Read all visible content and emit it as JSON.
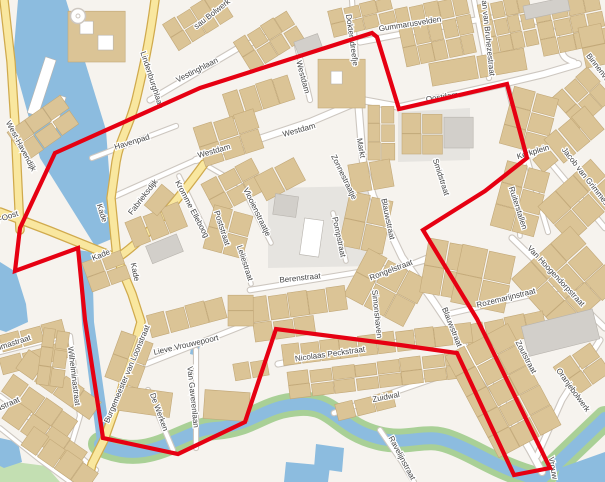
{
  "map": {
    "title": "Town centre map with red boundary overlay",
    "background": "#f6f3ee",
    "colors": {
      "water": "#8cbcdf",
      "green": "#a9d096",
      "green_light": "#c3dfb2",
      "road_fill": "#ffffff",
      "road_casing": "#cdc7c0",
      "yellow_fill": "#f9e79f",
      "yellow_casing": "#d0aa4d",
      "building_tan": "#dbc496",
      "building_tan_stroke": "#c2a878",
      "building_gray": "#d2cfca",
      "building_gray_stroke": "#b8b4ae",
      "building_white": "#ffffff",
      "plaza": "#e6e4e0",
      "label": "#454545",
      "boundary": "#e60012"
    },
    "boundary": {
      "name": "red-boundary-polygon",
      "width": 4.2,
      "points": "55,153 200,88 372,33 377,37 399,109 507,84 527,158 485,191 423,230 477,319 550,468 514,475 457,353 400,345 276,329 245,422 178,454 103,438 85,320 78,248 15,271 20,228"
    },
    "plazas": [
      "M268,188 L372,186 L372,266 L268,268 Z",
      "M398,112 L470,108 L470,160 L398,162 Z"
    ],
    "water_fills": [
      "M18,0 L66,0 L106,130 L114,238 L95,246 L40,158 L13,60 Z",
      "M78,250 L92,252 L94,322 L110,434 L97,442 L82,324 Z",
      "M0,262 L16,272 L26,304 L28,322 L6,332 L0,330 Z",
      "M0,438 L18,442 L22,462 L4,468 L0,466 Z",
      "M192,342 L200,344 L198,356 L190,354 Z",
      "M316,444 L344,448 L342,472 L314,468 Z",
      "M286,462 L330,466 L328,482 L284,482 Z",
      "M560,468 L605,452 L605,482 L556,482 Z"
    ],
    "green_fills": [
      "M0,460 L46,466 L60,482 L0,482 Z"
    ],
    "moat_path": "M100,444 C150,468 180,430 215,428 C255,425 262,406 300,404 C335,402 338,428 378,438 C408,446 425,432 450,442 C478,452 495,468 540,480 L605,418",
    "moat_green_width": 24,
    "moat_water_width": 12,
    "yellow_roads": [
      "M155,0 C149,45 143,70 136,100 C129,128 120,138 116,162 L111,198 L117,258 L132,294 L141,322 L121,392 L104,440 L92,464 L88,482",
      "M0,212 L50,231 L117,258",
      "M117,258 C142,242 172,208 204,164",
      "M4,0 L11,62 L15,124 L20,230"
    ],
    "white_roads": [
      [
        "M196,160 L310,122 L362,100 L400,107 L506,83 L544,74 L578,64",
        6
      ],
      [
        "M111,198 L196,160",
        4.5
      ],
      [
        "M352,0 L356,60 L358,98",
        4
      ],
      [
        "M360,42 L470,21 C515,13 548,18 557,38 C563,52 560,58 574,62",
        5
      ],
      [
        "M474,0 L489,78",
        4
      ],
      [
        "M150,100 L240,47 L270,36",
        5
      ],
      [
        "M297,46 L310,100",
        4
      ],
      [
        "M358,100 L363,162 L373,196 L402,257 L434,302 L464,347 L502,402 L530,450 L542,472",
        6
      ],
      [
        "M507,84 L516,120 L527,158 L540,205 L548,232",
        4
      ],
      [
        "M540,150 L605,228",
        4.5
      ],
      [
        "M512,238 L605,328",
        5
      ],
      [
        "M448,314 L560,288 L605,284",
        4.5
      ],
      [
        "M250,290 L360,272 L404,266 L434,258",
        4.5
      ],
      [
        "M358,286 L440,252",
        3.5
      ],
      [
        "M278,364 L480,327",
        5
      ],
      [
        "M334,413 L490,359",
        4.5
      ],
      [
        "M600,340 L562,400 L537,456",
        5
      ],
      [
        "M380,430 L402,462 L414,482",
        4
      ],
      [
        "M146,364 L232,330 L252,322",
        4.5
      ],
      [
        "M70,336 L80,416 L66,462",
        4
      ],
      [
        "M0,352 L64,336",
        4
      ],
      [
        "M0,396 L60,440 L96,470",
        4
      ],
      [
        "M0,428 L40,460 L70,482",
        3.5
      ],
      [
        "M196,350 L196,448",
        4
      ],
      [
        "M148,390 L173,450",
        4
      ],
      [
        "M242,186 L271,243",
        3.5
      ],
      [
        "M240,244 L251,284",
        3.5
      ],
      [
        "M216,208 L229,250",
        3.5
      ],
      [
        "M179,176 L213,246",
        3.5
      ],
      [
        "M333,213 L346,261",
        3.5
      ],
      [
        "M334,159 L356,199",
        3.5
      ],
      [
        "M373,283 L381,347",
        3.5
      ],
      [
        "M92,158 L176,126",
        4
      ],
      [
        "M527,158 L516,180 L520,236",
        3.5
      ],
      [
        "M204,164 L242,186",
        3.5
      ]
    ],
    "buildings": [
      [
        68,
        12,
        58,
        50,
        0,
        1,
        1,
        0
      ],
      [
        80,
        22,
        14,
        12,
        0,
        1,
        1,
        2
      ],
      [
        98,
        36,
        16,
        14,
        0,
        1,
        1,
        2
      ],
      [
        166,
        6,
        64,
        30,
        -32,
        4,
        2,
        0
      ],
      [
        238,
        24,
        62,
        34,
        -32,
        4,
        2,
        0
      ],
      [
        296,
        38,
        26,
        16,
        -20,
        1,
        1,
        1
      ],
      [
        318,
        60,
        48,
        48,
        0,
        1,
        1,
        0
      ],
      [
        331,
        72,
        12,
        12,
        0,
        1,
        1,
        2
      ],
      [
        225,
        84,
        68,
        26,
        -18,
        4,
        1,
        0
      ],
      [
        330,
        4,
        64,
        26,
        -14,
        4,
        2,
        0
      ],
      [
        400,
        2,
        72,
        58,
        -12,
        5,
        3,
        0
      ],
      [
        482,
        0,
        52,
        50,
        -12,
        4,
        3,
        0
      ],
      [
        430,
        56,
        96,
        22,
        -10,
        2,
        1,
        0
      ],
      [
        538,
        0,
        66,
        50,
        -12,
        4,
        3,
        0
      ],
      [
        524,
        2,
        46,
        13,
        -12,
        1,
        1,
        1
      ],
      [
        560,
        78,
        46,
        40,
        -42,
        3,
        2,
        0
      ],
      [
        582,
        26,
        24,
        40,
        -12,
        1,
        2,
        0
      ],
      [
        402,
        114,
        40,
        40,
        0,
        2,
        2,
        0
      ],
      [
        444,
        118,
        30,
        30,
        0,
        1,
        1,
        1
      ],
      [
        368,
        106,
        26,
        54,
        0,
        2,
        3,
        0
      ],
      [
        506,
        92,
        46,
        58,
        15,
        2,
        3,
        0
      ],
      [
        548,
        120,
        52,
        30,
        -40,
        3,
        1,
        0
      ],
      [
        536,
        152,
        20,
        16,
        -40,
        1,
        1,
        0
      ],
      [
        498,
        166,
        44,
        66,
        15,
        2,
        3,
        0
      ],
      [
        556,
        166,
        48,
        70,
        48,
        2,
        3,
        0
      ],
      [
        528,
        242,
        76,
        78,
        48,
        3,
        3,
        0
      ],
      [
        466,
        318,
        80,
        24,
        -12,
        4,
        1,
        0
      ],
      [
        198,
        118,
        62,
        40,
        -18,
        3,
        2,
        0
      ],
      [
        206,
        170,
        56,
        34,
        -28,
        3,
        2,
        0
      ],
      [
        208,
        210,
        40,
        44,
        15,
        2,
        2,
        0
      ],
      [
        258,
        166,
        44,
        26,
        -28,
        2,
        1,
        0
      ],
      [
        274,
        196,
        24,
        20,
        8,
        1,
        1,
        1
      ],
      [
        302,
        220,
        20,
        36,
        8,
        1,
        1,
        2
      ],
      [
        344,
        196,
        44,
        54,
        12,
        2,
        2,
        0
      ],
      [
        350,
        162,
        42,
        28,
        -10,
        2,
        1,
        0
      ],
      [
        352,
        262,
        68,
        52,
        28,
        3,
        2,
        0
      ],
      [
        250,
        292,
        96,
        24,
        -8,
        5,
        1,
        0
      ],
      [
        254,
        320,
        60,
        18,
        -8,
        3,
        1,
        0
      ],
      [
        424,
        242,
        42,
        54,
        10,
        2,
        2,
        0
      ],
      [
        456,
        250,
        54,
        58,
        12,
        2,
        2,
        0
      ],
      [
        282,
        334,
        190,
        20,
        -7,
        10,
        1,
        0
      ],
      [
        288,
        362,
        180,
        26,
        -7,
        8,
        2,
        0
      ],
      [
        468,
        334,
        70,
        114,
        -28,
        3,
        5,
        0
      ],
      [
        524,
        318,
        74,
        30,
        -14,
        1,
        1,
        1
      ],
      [
        560,
        352,
        44,
        36,
        -35,
        2,
        2,
        0
      ],
      [
        336,
        398,
        58,
        16,
        -14,
        3,
        1,
        0
      ],
      [
        148,
        306,
        78,
        22,
        -15,
        4,
        1,
        0
      ],
      [
        228,
        296,
        26,
        30,
        0,
        1,
        2,
        0
      ],
      [
        0,
        328,
        64,
        16,
        -15,
        3,
        1,
        0
      ],
      [
        0,
        350,
        70,
        16,
        -15,
        3,
        1,
        0
      ],
      [
        14,
        374,
        90,
        22,
        35,
        4,
        1,
        0
      ],
      [
        0,
        396,
        80,
        20,
        35,
        4,
        1,
        0
      ],
      [
        0,
        424,
        90,
        22,
        35,
        4,
        1,
        0
      ],
      [
        20,
        448,
        80,
        22,
        35,
        4,
        1,
        0
      ],
      [
        112,
        336,
        34,
        48,
        20,
        2,
        2,
        0
      ],
      [
        118,
        390,
        54,
        24,
        8,
        1,
        1,
        0
      ],
      [
        204,
        392,
        46,
        28,
        4,
        1,
        1,
        0
      ],
      [
        234,
        362,
        34,
        16,
        -10,
        2,
        1,
        0
      ],
      [
        36,
        58,
        12,
        58,
        18,
        1,
        1,
        2
      ],
      [
        52,
        96,
        8,
        44,
        18,
        1,
        1,
        2
      ],
      [
        40,
        330,
        26,
        56,
        8,
        2,
        3,
        0
      ],
      [
        26,
        96,
        34,
        64,
        55,
        2,
        3,
        0
      ],
      [
        128,
        212,
        56,
        26,
        -22,
        3,
        1,
        0
      ],
      [
        148,
        240,
        34,
        18,
        -22,
        1,
        1,
        1
      ],
      [
        146,
        192,
        28,
        16,
        -50,
        1,
        1,
        0
      ],
      [
        86,
        256,
        40,
        30,
        -20,
        2,
        2,
        0
      ]
    ],
    "landmark_circle": {
      "x": 78,
      "y": 16,
      "r": 7.5
    },
    "labels": [
      [
        "sau Bolwerk",
        212,
        14,
        -38
      ],
      [
        "Lindenburghlaan",
        152,
        80,
        72
      ],
      [
        "Vestinghlaan",
        197,
        70,
        -27
      ],
      [
        "Havenpad",
        132,
        142,
        -17
      ],
      [
        "West-Havendijk",
        21,
        146,
        62
      ],
      [
        "Westdam",
        303,
        77,
        75
      ],
      [
        "Westdam",
        299,
        130,
        -16
      ],
      [
        "Westdam",
        214,
        151,
        -16
      ],
      [
        "Doktersdreefje",
        352,
        40,
        82
      ],
      [
        "Gummarusvelden",
        410,
        24,
        -9
      ],
      [
        "Jan van Bruhezestraat",
        488,
        36,
        84
      ],
      [
        "Binnenvest",
        600,
        70,
        52
      ],
      [
        "Oostdam",
        442,
        97,
        -9
      ],
      [
        "Kerkplein",
        533,
        152,
        -17
      ],
      [
        "Markt",
        361,
        148,
        80
      ],
      [
        "Zonnestraatje",
        344,
        177,
        64
      ],
      [
        "Zeelandweg-Oost",
        -12,
        223,
        -18
      ],
      [
        "Kade",
        102,
        213,
        72
      ],
      [
        "Kade",
        101,
        255,
        -22
      ],
      [
        "Kade",
        135,
        272,
        78
      ],
      [
        "Fabrieksdijk",
        143,
        197,
        -52
      ],
      [
        "Kromme Elleboog",
        192,
        209,
        62
      ],
      [
        "Poststraat",
        222,
        228,
        72
      ],
      [
        "Vlooienstraatje",
        257,
        212,
        64
      ],
      [
        "Leliestraat",
        245,
        263,
        72
      ],
      [
        "Berenstraat",
        300,
        278,
        -6
      ],
      [
        "Pompstraat",
        339,
        237,
        78
      ],
      [
        "Blauwstraat",
        388,
        219,
        78
      ],
      [
        "Blauwstraat",
        452,
        327,
        68
      ],
      [
        "Rongelstraat",
        391,
        270,
        -21
      ],
      [
        "Simonshaven",
        377,
        314,
        84
      ],
      [
        "Smidstraat",
        441,
        177,
        72
      ],
      [
        "Ruiterstallen",
        518,
        208,
        72
      ],
      [
        "Jacob van Grimmesteijnstraat",
        596,
        190,
        52
      ],
      [
        "Van Hoogendorpstraat",
        556,
        276,
        47
      ],
      [
        "Rozemarijnstraat",
        506,
        298,
        -14
      ],
      [
        "Zoutstraat",
        526,
        357,
        62
      ],
      [
        "Oranjebolwerk",
        573,
        390,
        54
      ],
      [
        "Vrouw",
        553,
        468,
        80
      ],
      [
        "Nicolaas Peckstraat",
        330,
        354,
        -8
      ],
      [
        "Zuidwal",
        386,
        397,
        -11
      ],
      [
        "Ravelijnstraat",
        402,
        458,
        62
      ],
      [
        "Lieve Vrouwepoort",
        186,
        345,
        -13
      ],
      [
        "Burgemeester van Loonstraat",
        127,
        374,
        -67
      ],
      [
        "Wilhelminastraat",
        74,
        376,
        83
      ],
      [
        "Emmastraat",
        10,
        344,
        -18
      ],
      [
        "astraat",
        8,
        404,
        -24
      ],
      [
        "De Werken",
        159,
        412,
        70
      ],
      [
        "Van Gaverenlaan",
        193,
        397,
        84
      ]
    ]
  }
}
